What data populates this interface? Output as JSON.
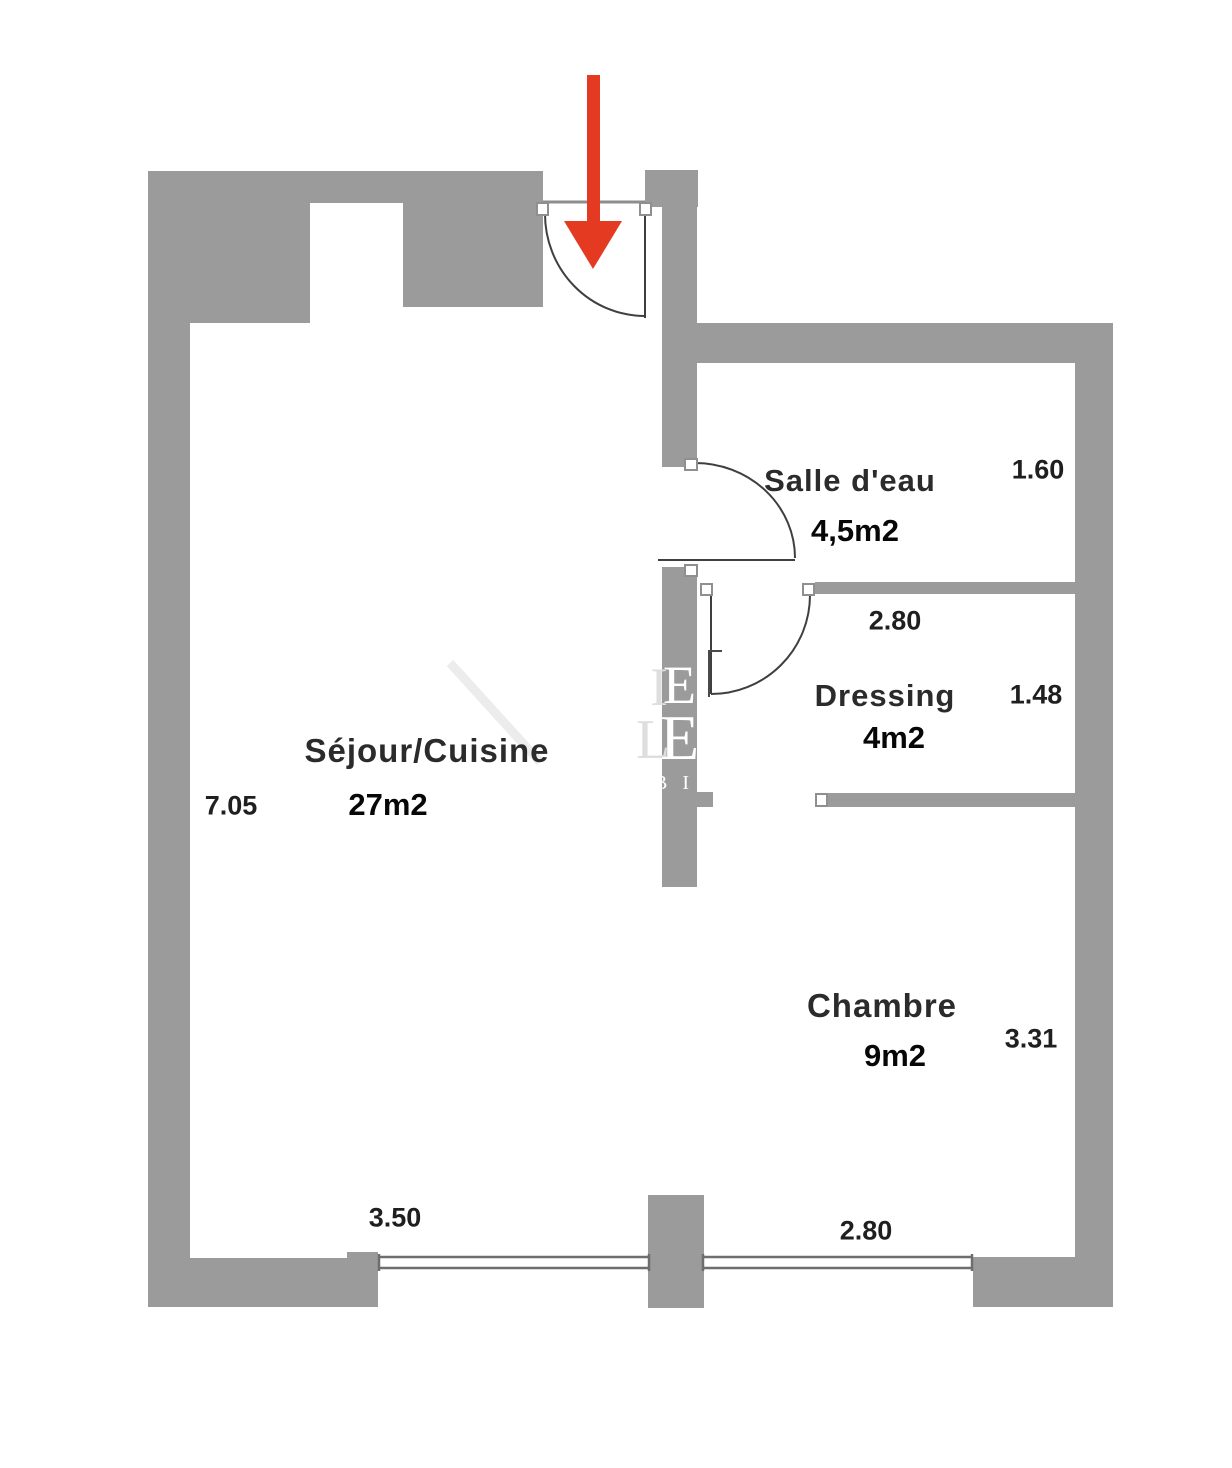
{
  "colors": {
    "wall": "#9b9b9b",
    "arrow": "#e43a22",
    "line": "#3f3f3f",
    "window": "#6e6e6e",
    "jamb": "#8f8f8f"
  },
  "rooms": {
    "sejour": {
      "name": "Séjour/Cuisine",
      "area": "27m2",
      "dim_side": "7.05",
      "dim_window": "3.50"
    },
    "salle_deau": {
      "name": "Salle d'eau",
      "area": "4,5m2",
      "dim_side": "1.60"
    },
    "dressing": {
      "name": "Dressing",
      "area": "4m2",
      "dim_side": "1.48",
      "dim_top": "2.80"
    },
    "chambre": {
      "name": "Chambre",
      "area": "9m2",
      "dim_side": "3.31",
      "dim_window": "2.80"
    }
  },
  "watermark": {
    "line1_left": "I",
    "line1_right": "E",
    "line2_left": "L",
    "line2_right": "E",
    "line3": "B I"
  },
  "icons": {
    "entrance_arrow": "arrow-down"
  }
}
